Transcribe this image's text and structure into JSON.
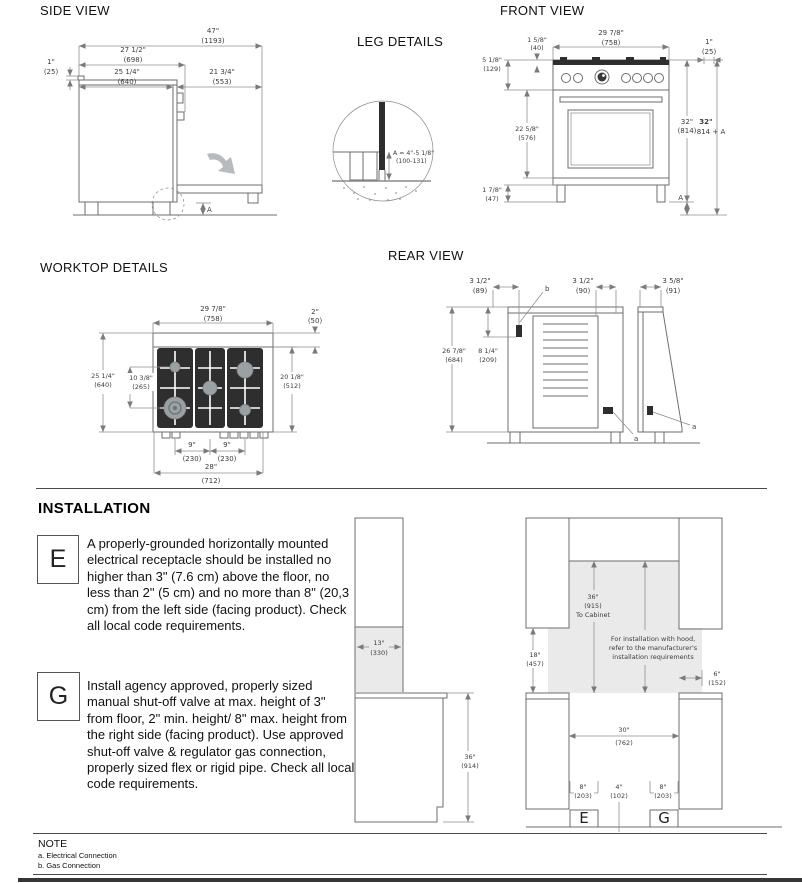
{
  "titles": {
    "side_view": "SIDE VIEW",
    "front_view": "FRONT VIEW",
    "leg_details": "LEG DETAILS",
    "worktop_details": "WORKTOP DETAILS",
    "rear_view": "REAR VIEW"
  },
  "side_view": {
    "d47_in": "47\"",
    "d47_mm": "(1193)",
    "d27_in": "27 1/2\"",
    "d27_mm": "(698)",
    "d25_in": "25 1/4\"",
    "d25_mm": "(640)",
    "d21_in": "21 3/4\"",
    "d21_mm": "(553)",
    "d1_in": "1\"",
    "d1_mm": "(25)",
    "a": "A"
  },
  "front_view": {
    "d158_in": "1 5/8\"",
    "d158_mm": "(40)",
    "d2978_in": "29 7/8\"",
    "d2978_mm": "(758)",
    "d1_in": "1\"",
    "d1_mm": "(25)",
    "d518_in": "5 1/8\"",
    "d518_mm": "(129)",
    "d2258_in": "22 5/8\"",
    "d2258_mm": "(576)",
    "d32_in": "32\"",
    "d32_mm": "(814)",
    "d32a_in": "32\"",
    "d32a_mm": "814 + A",
    "d178_in": "1 7/8\"",
    "d178_mm": "(47)",
    "a": "A"
  },
  "leg_details": {
    "formula_l1": "A = 4\"-5 1/8\"",
    "formula_l2": "(100-131)"
  },
  "worktop": {
    "d2978_in": "29 7/8\"",
    "d2978_mm": "(758)",
    "d2_in": "2\"",
    "d2_mm": "(50)",
    "d2514_in": "25 1/4\"",
    "d2514_mm": "(640)",
    "d1038_in": "10 3/8\"",
    "d1038_mm": "(265)",
    "d2018_in": "20 1/8\"",
    "d2018_mm": "(512)",
    "d9a_in": "9\"",
    "d9a_mm": "(230)",
    "d9b_in": "9\"",
    "d9b_mm": "(230)",
    "d28_in": "28\"",
    "d28_mm": "(712)"
  },
  "rear_view": {
    "d312a_in": "3 1/2\"",
    "d312a_mm": "(89)",
    "d312b_in": "3 1/2\"",
    "d312b_mm": "(90)",
    "d358_in": "3 5/8\"",
    "d358_mm": "(91)",
    "d2678_in": "26 7/8\"",
    "d2678_mm": "(684)",
    "d814_in": "8 1/4\"",
    "d814_mm": "(209)",
    "a1": "a",
    "a2": "a",
    "b": "b"
  },
  "installation": {
    "heading": "INSTALLATION",
    "e_label": "E",
    "e_text": "A properly-grounded horizontally mounted electrical receptacle should be installed no higher than 3\" (7.6 cm) above the floor, no less than 2\" (5 cm) and no more than 8\" (20,3 cm) from the left side (facing product). Check all local code requirements.",
    "g_label": "G",
    "g_text": "Install agency approved, properly sized manual shut-off valve at max. height of 3\" from floor, 2\" min. height/ 8\" max. height from the right side (facing product). Use approved shut-off valve & regulator gas connection, properly sized flex or rigid pipe. Check all local code requirements.",
    "left": {
      "d13_in": "13\"",
      "d13_mm": "(330)",
      "d36_in": "36\"",
      "d36_mm": "(914)"
    },
    "right": {
      "d36_in": "36\"",
      "d36_mm": "(915)",
      "d36_note": "To Cabinet",
      "hood_l1": "For installation with hood,",
      "hood_l2": "refer to the manufacturer's",
      "hood_l3": "installation requirements",
      "d18_in": "18\"",
      "d18_mm": "(457)",
      "d6_in": "6\"",
      "d6_mm": "(152)",
      "d30_in": "30\"",
      "d30_mm": "(762)",
      "d8l_in": "8\"",
      "d8l_mm": "(203)",
      "d4_in": "4\"",
      "d4_mm": "(102)",
      "d8r_in": "8\"",
      "d8r_mm": "(203)",
      "e_label": "E",
      "g_label": "G"
    }
  },
  "note": {
    "heading": "NOTE",
    "item_a": "a. Electrical Connection",
    "item_b": "b. Gas Connection"
  }
}
